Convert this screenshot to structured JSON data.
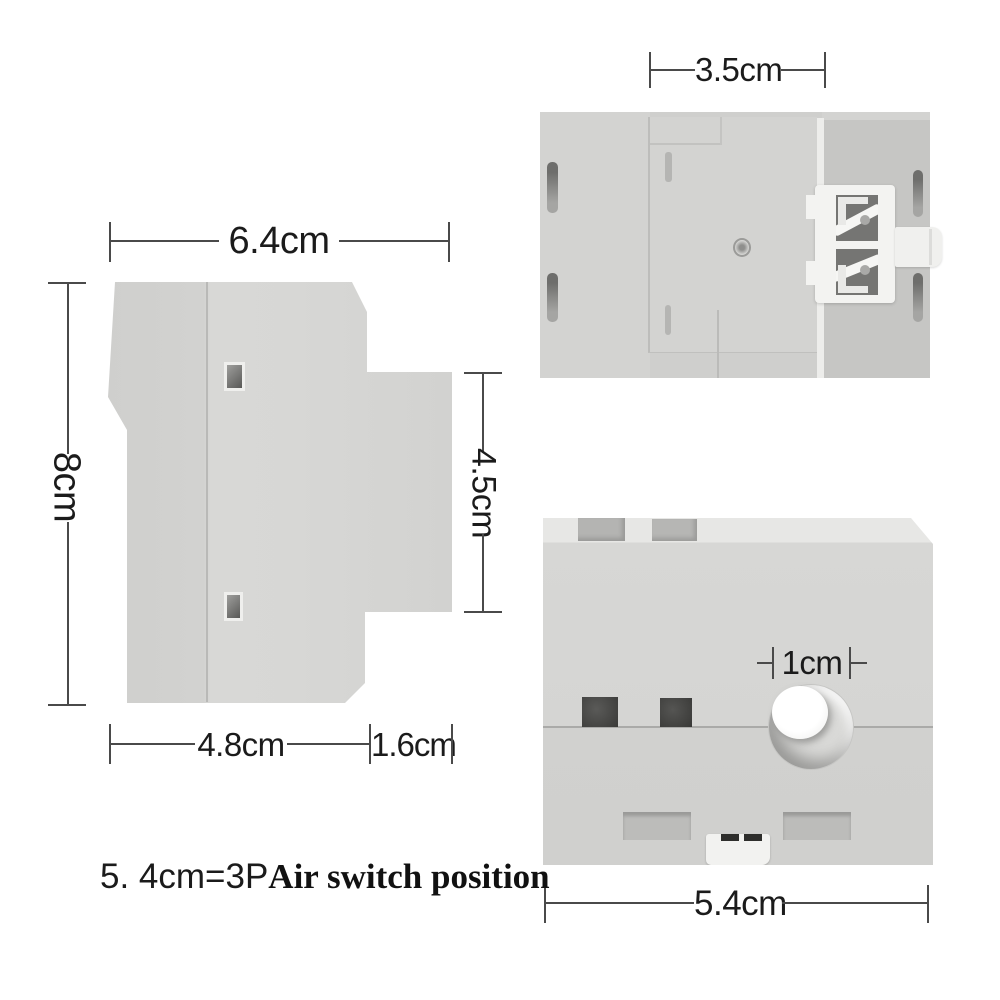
{
  "labels": {
    "side_width": "6.4cm",
    "side_height": "8cm",
    "side_right_height": "4.5cm",
    "side_bottom_left": "4.8cm",
    "side_bottom_right": "1.6cm",
    "back_center_width": "3.5cm",
    "front_hole": "1cm",
    "front_width": "5.4cm"
  },
  "caption": {
    "prefix": "5. 4cm=3P",
    "emphasis": "Air switch position"
  },
  "colors": {
    "background": "#ffffff",
    "body_gray": "#d5d5d3",
    "cap_gray": "#c8c8c6",
    "strip_light": "#e7e7e5",
    "dark_hole": "#3f3f3d",
    "clip_white": "#f3f3f1",
    "dimension_line": "#4a4a4a",
    "text": "#1b1b1b"
  }
}
